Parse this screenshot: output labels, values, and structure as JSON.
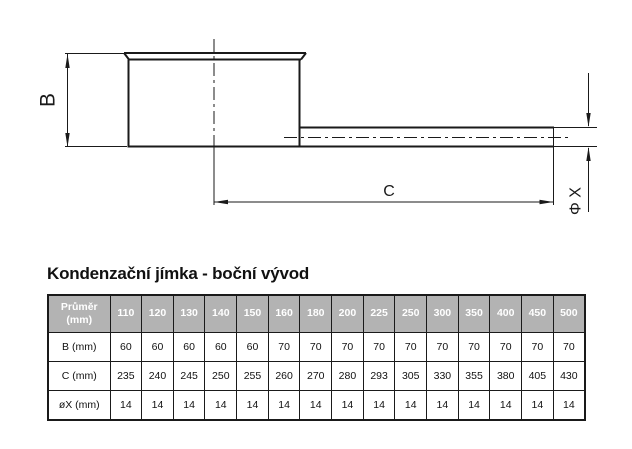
{
  "title": "Kondenzační jímka - boční vývod",
  "colors": {
    "line": "#1a1a1a",
    "header_bg": "#b3b3b3",
    "header_text": "#ffffff"
  },
  "drawing": {
    "label_b": "B",
    "label_c": "C",
    "label_phi_x": "Φ X"
  },
  "table": {
    "corner": {
      "line1": "Průměr",
      "line2": "(mm)"
    },
    "diameters": [
      "110",
      "120",
      "130",
      "140",
      "150",
      "160",
      "180",
      "200",
      "225",
      "250",
      "300",
      "350",
      "400",
      "450",
      "500"
    ],
    "rows": [
      {
        "label": "B (mm)",
        "values": [
          "60",
          "60",
          "60",
          "60",
          "60",
          "70",
          "70",
          "70",
          "70",
          "70",
          "70",
          "70",
          "70",
          "70",
          "70"
        ]
      },
      {
        "label": "C (mm)",
        "values": [
          "235",
          "240",
          "245",
          "250",
          "255",
          "260",
          "270",
          "280",
          "293",
          "305",
          "330",
          "355",
          "380",
          "405",
          "430"
        ]
      },
      {
        "label": "øX (mm)",
        "values": [
          "14",
          "14",
          "14",
          "14",
          "14",
          "14",
          "14",
          "14",
          "14",
          "14",
          "14",
          "14",
          "14",
          "14",
          "14"
        ]
      }
    ]
  }
}
